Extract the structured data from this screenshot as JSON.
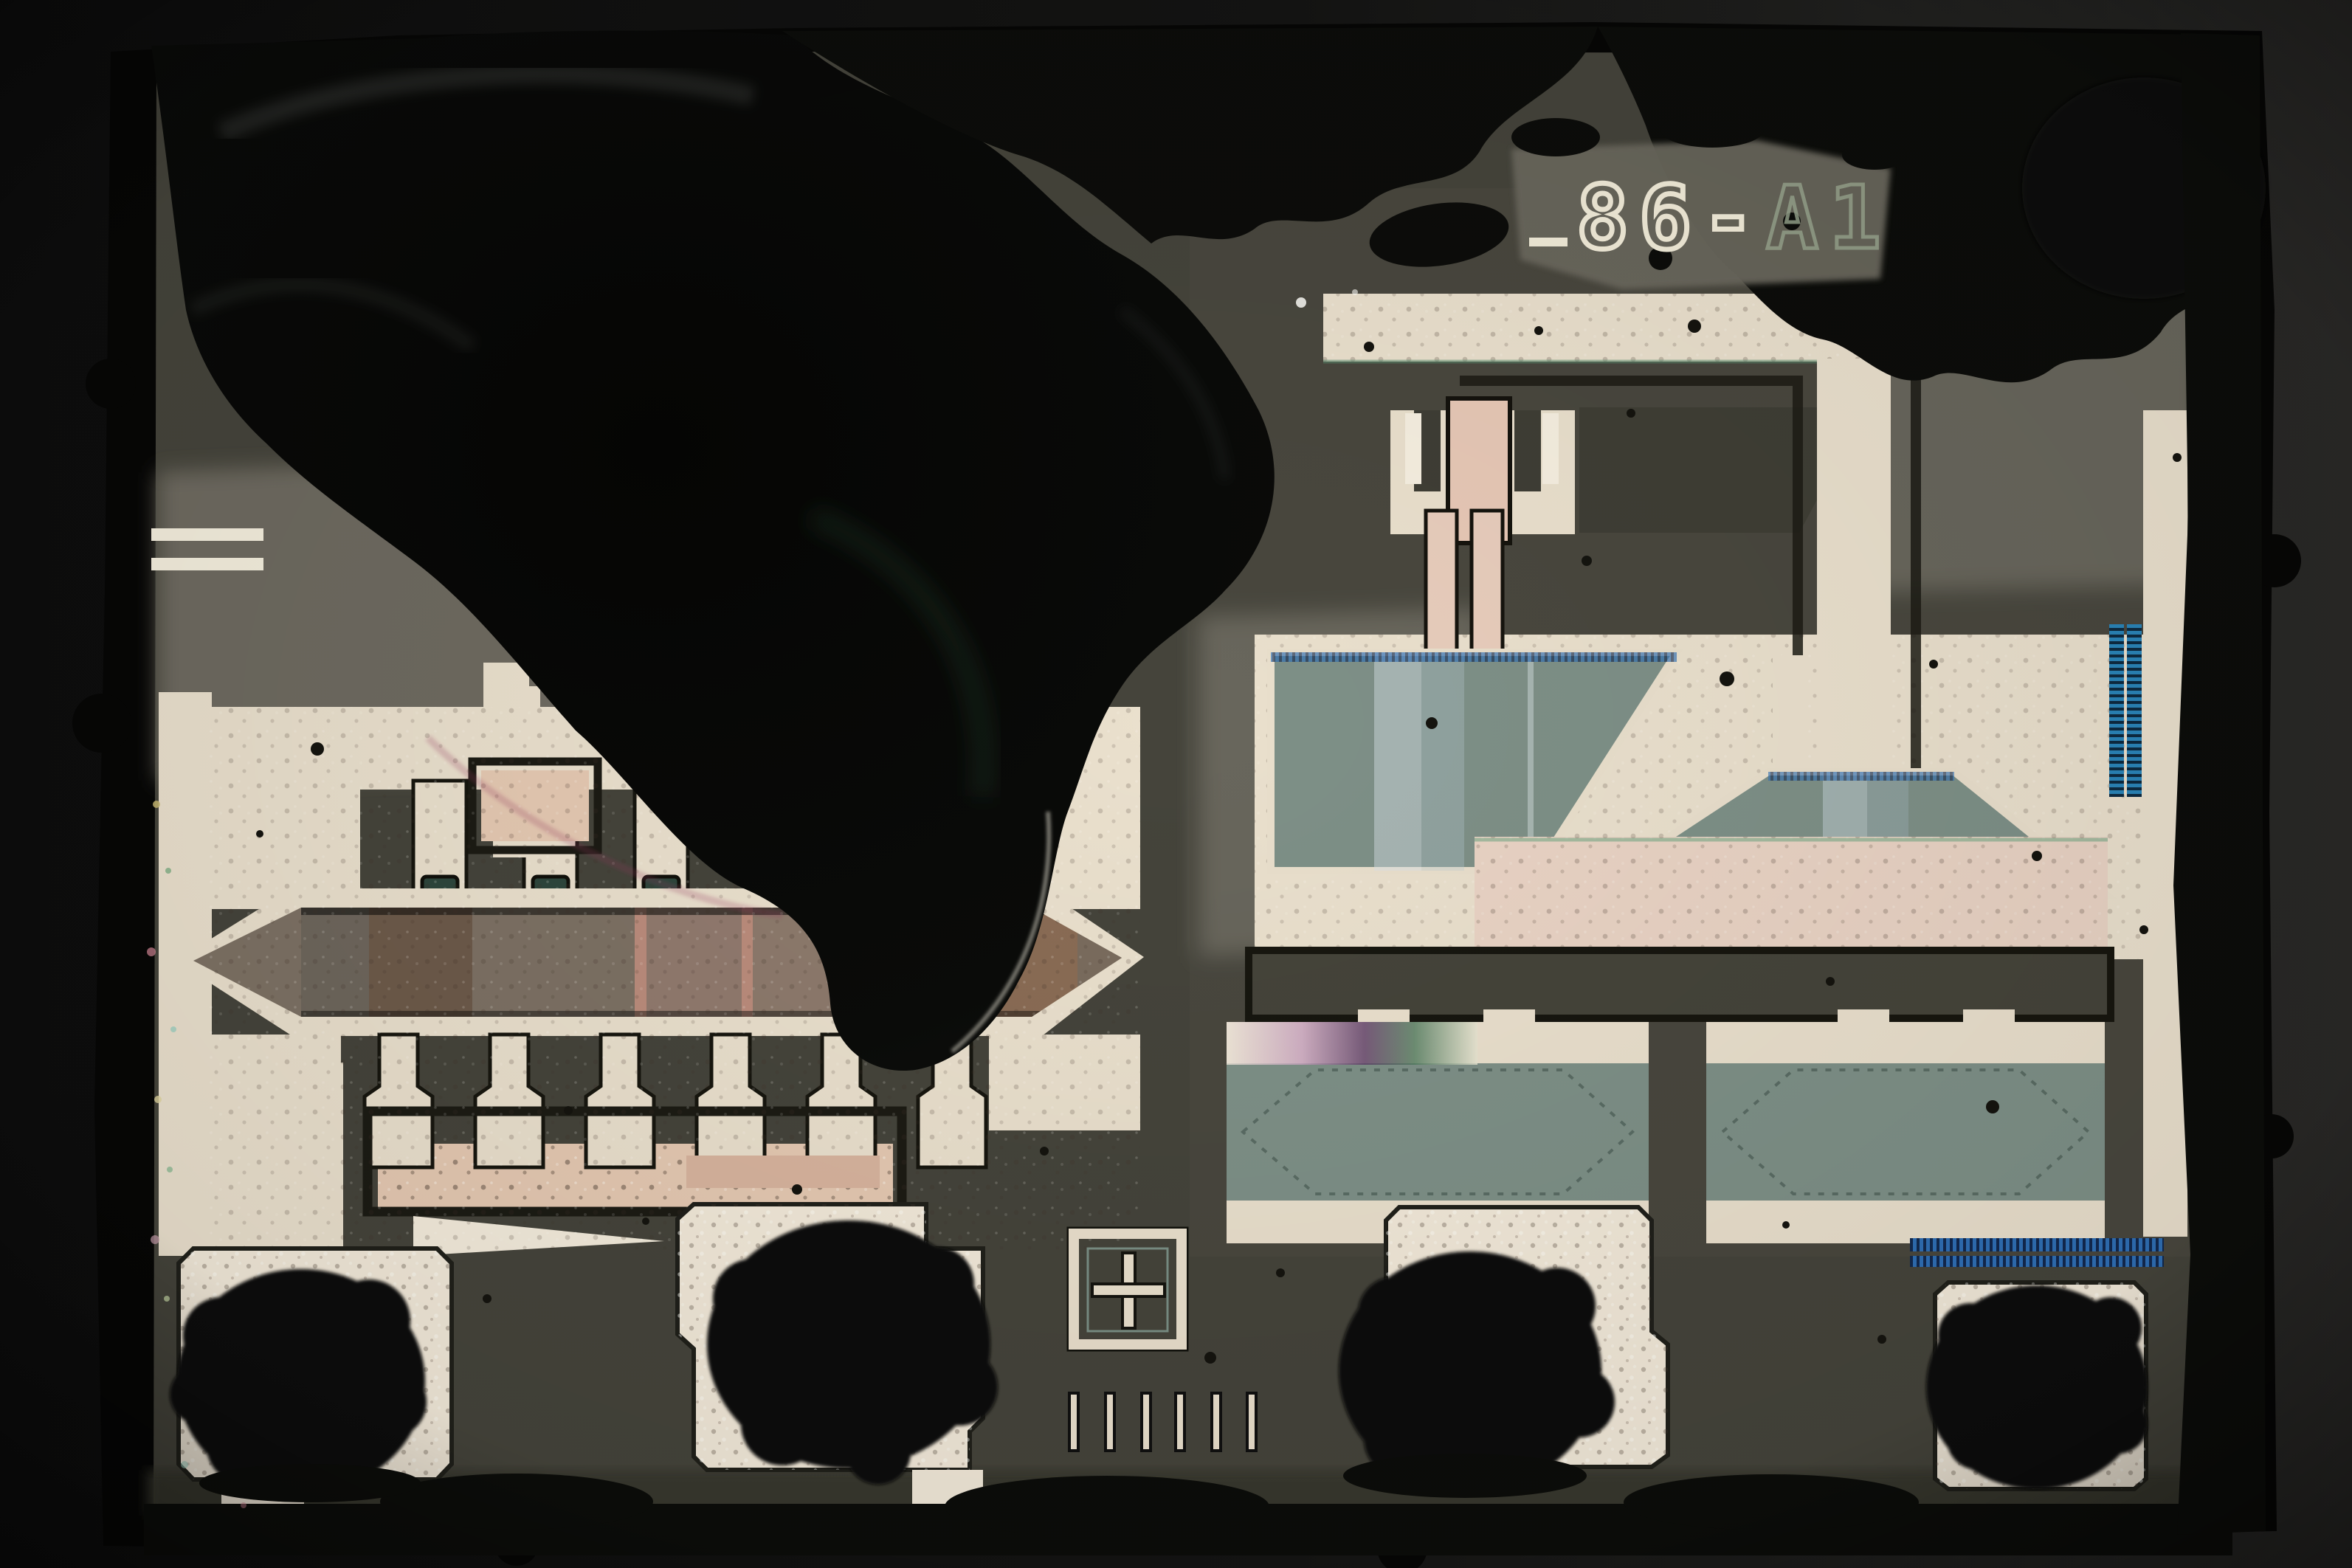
{
  "meta": {
    "description": "Optical microscope photograph of a decapped integrated-circuit die, top metal layer, with a large opaque dark residue blob covering the upper-left region and crud along the top and right die edges",
    "subject": "IC die micrograph"
  },
  "die": {
    "marking_prefix": "_",
    "marking_primary": "86-",
    "marking_secondary": "A1",
    "marking_full": "_86-A1"
  },
  "features": {
    "bond_pad_count": 4,
    "bond_pad_residue": "dark ball-bond residue on every pad",
    "alignment_mark": "cross-in-square",
    "calibration_tick_count": 6,
    "trapezoid_plate_count": 2,
    "capacitor_plate_count": 2,
    "resistor_hexagon_count": 1
  },
  "palette": {
    "bg_left": "#0e0e0e",
    "bg_right": "#2a2927",
    "die_edge": "#060605",
    "die_surface": "#45443b",
    "circuit_bg": "#4c4b41",
    "surface_light": "#6e6b61",
    "surface_lighter": "#8a877b",
    "marking_patch": "#6b685d",
    "metal": "#eae0cd",
    "metal_bright": "#f2e9d9",
    "sage": "#7e9087",
    "sage_band": "#c3d2d6",
    "hex_base": "#7d7164",
    "hex_brown": "#6d5a4a",
    "hex_pink": "#bb8c7c",
    "salmon": "#e5c9b2",
    "blue_stripe": "#2f6fb5",
    "blue_stripe_dark": "#12294f",
    "blue_ladder": "#2a84b8",
    "teal_cap": "#2e463c",
    "outline_dark": "#1c1b14",
    "speck": "#15140f",
    "blob": "#0a0a08",
    "residue": "#0c0d0a",
    "text_bright": "#f2ecd9",
    "text_dim": "#9aa78f",
    "rim_pink": "#a34a63",
    "rim_green": "#2e5c44"
  }
}
